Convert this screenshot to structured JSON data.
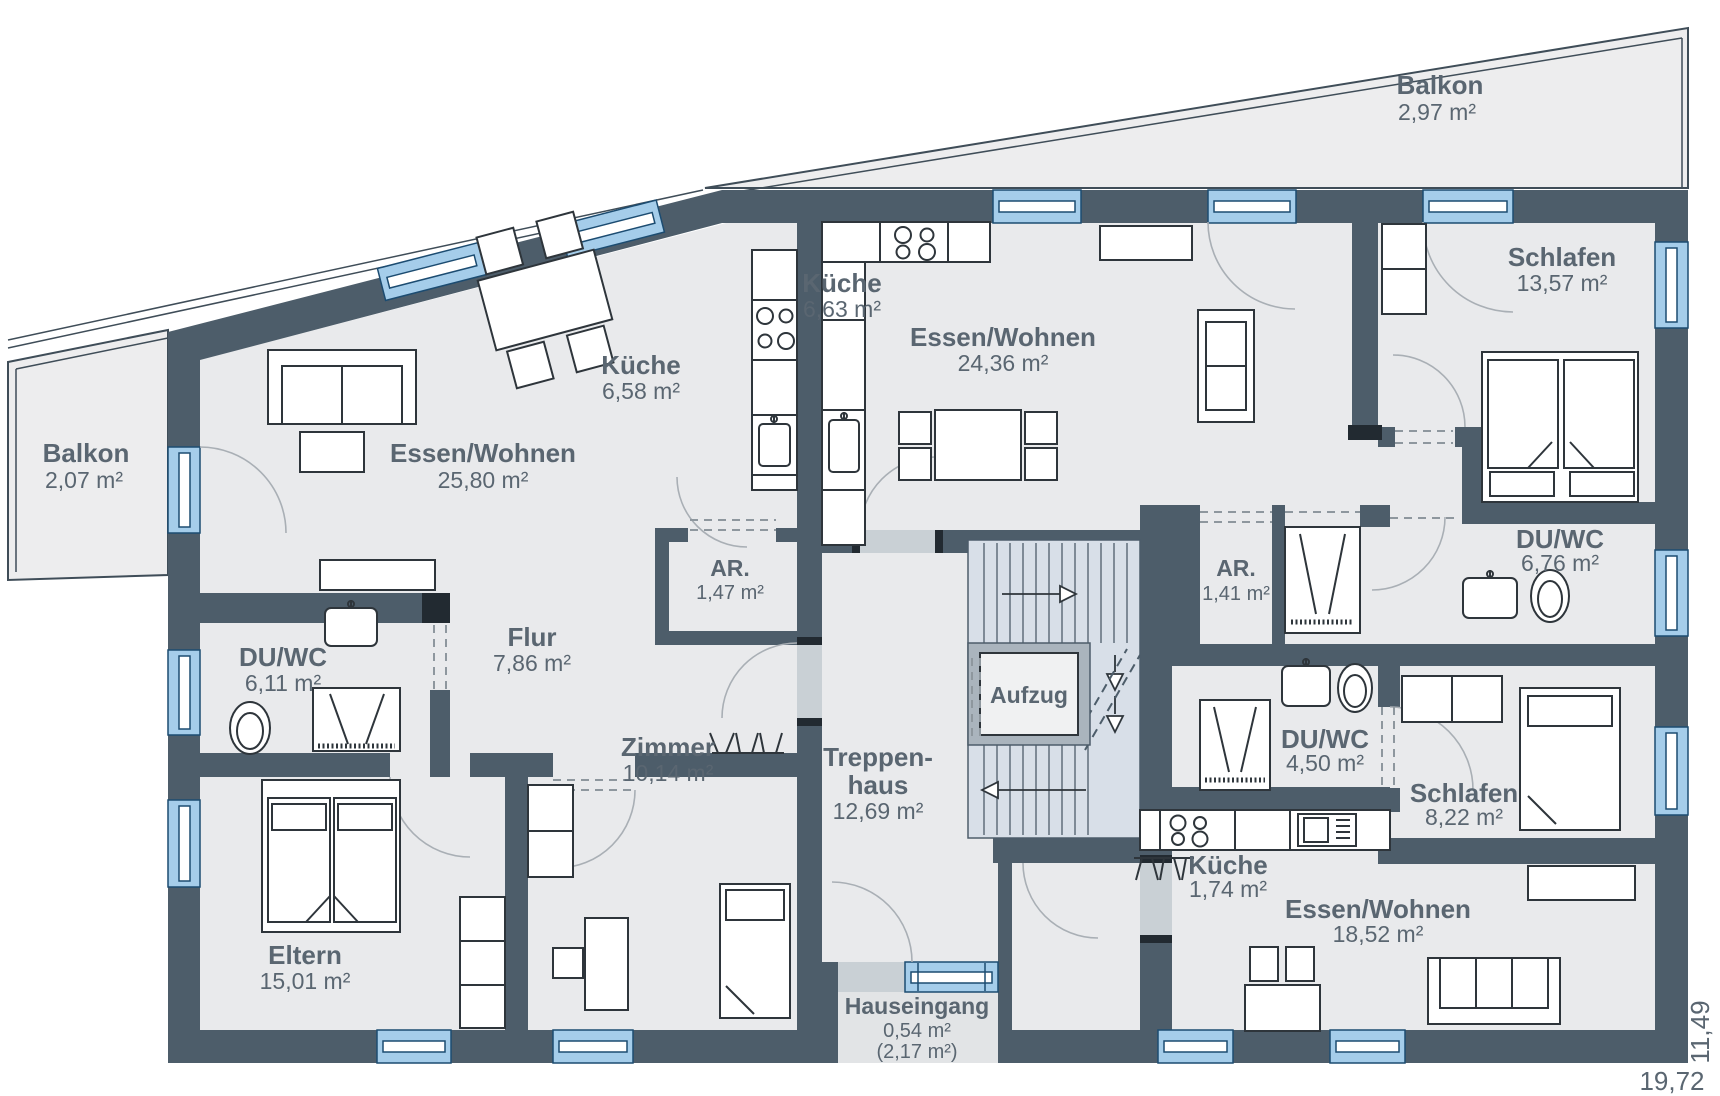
{
  "rooms": {
    "balkon_right": {
      "name": "Balkon",
      "area": "2,97 m²"
    },
    "balkon_left": {
      "name": "Balkon",
      "area": "2,07 m²"
    },
    "essen_left": {
      "name": "Essen/Wohnen",
      "area": "25,80 m²"
    },
    "kueche_left": {
      "name": "Küche",
      "area": "6,58 m²"
    },
    "kueche_mid": {
      "name": "Küche",
      "area": "6,63 m²"
    },
    "essen_mid": {
      "name": "Essen/Wohnen",
      "area": "24,36 m²"
    },
    "schlafen_tr": {
      "name": "Schlafen",
      "area": "13,57 m²"
    },
    "duwc_tr": {
      "name": "DU/WC",
      "area": "6,76 m²"
    },
    "ar_left": {
      "name": "AR.",
      "area": "1,47 m²"
    },
    "ar_right": {
      "name": "AR.",
      "area": "1,41 m²"
    },
    "duwc_left": {
      "name": "DU/WC",
      "area": "6,11 m²"
    },
    "flur": {
      "name": "Flur",
      "area": "7,86 m²"
    },
    "aufzug": {
      "name": "Aufzug"
    },
    "treppenhaus": {
      "name_line1": "Treppen-",
      "name_line2": "haus",
      "area": "12,69 m²"
    },
    "duwc_mid": {
      "name": "DU/WC",
      "area": "4,50 m²"
    },
    "zimmer": {
      "name": "Zimmer",
      "area": "10,14 m²"
    },
    "eltern": {
      "name": "Eltern",
      "area": "15,01 m²"
    },
    "kueche_br": {
      "name": "Küche",
      "area": "1,74 m²"
    },
    "schlafen_br": {
      "name": "Schlafen",
      "area": "8,22 m²"
    },
    "essen_br": {
      "name": "Essen/Wohnen",
      "area": "18,52 m²"
    },
    "hauseingang": {
      "name": "Hauseingang",
      "area": "0,54 m²",
      "area_alt": "(2,17 m²)"
    }
  },
  "dimension_labels": {
    "bottom": "19,72",
    "right": "11,49"
  },
  "colors": {
    "wall": "#4d5d6a",
    "window": "#a5cdea",
    "stair_fill": "#d8dfe8",
    "label": "#5a6671",
    "floor": "#e9eaec"
  }
}
